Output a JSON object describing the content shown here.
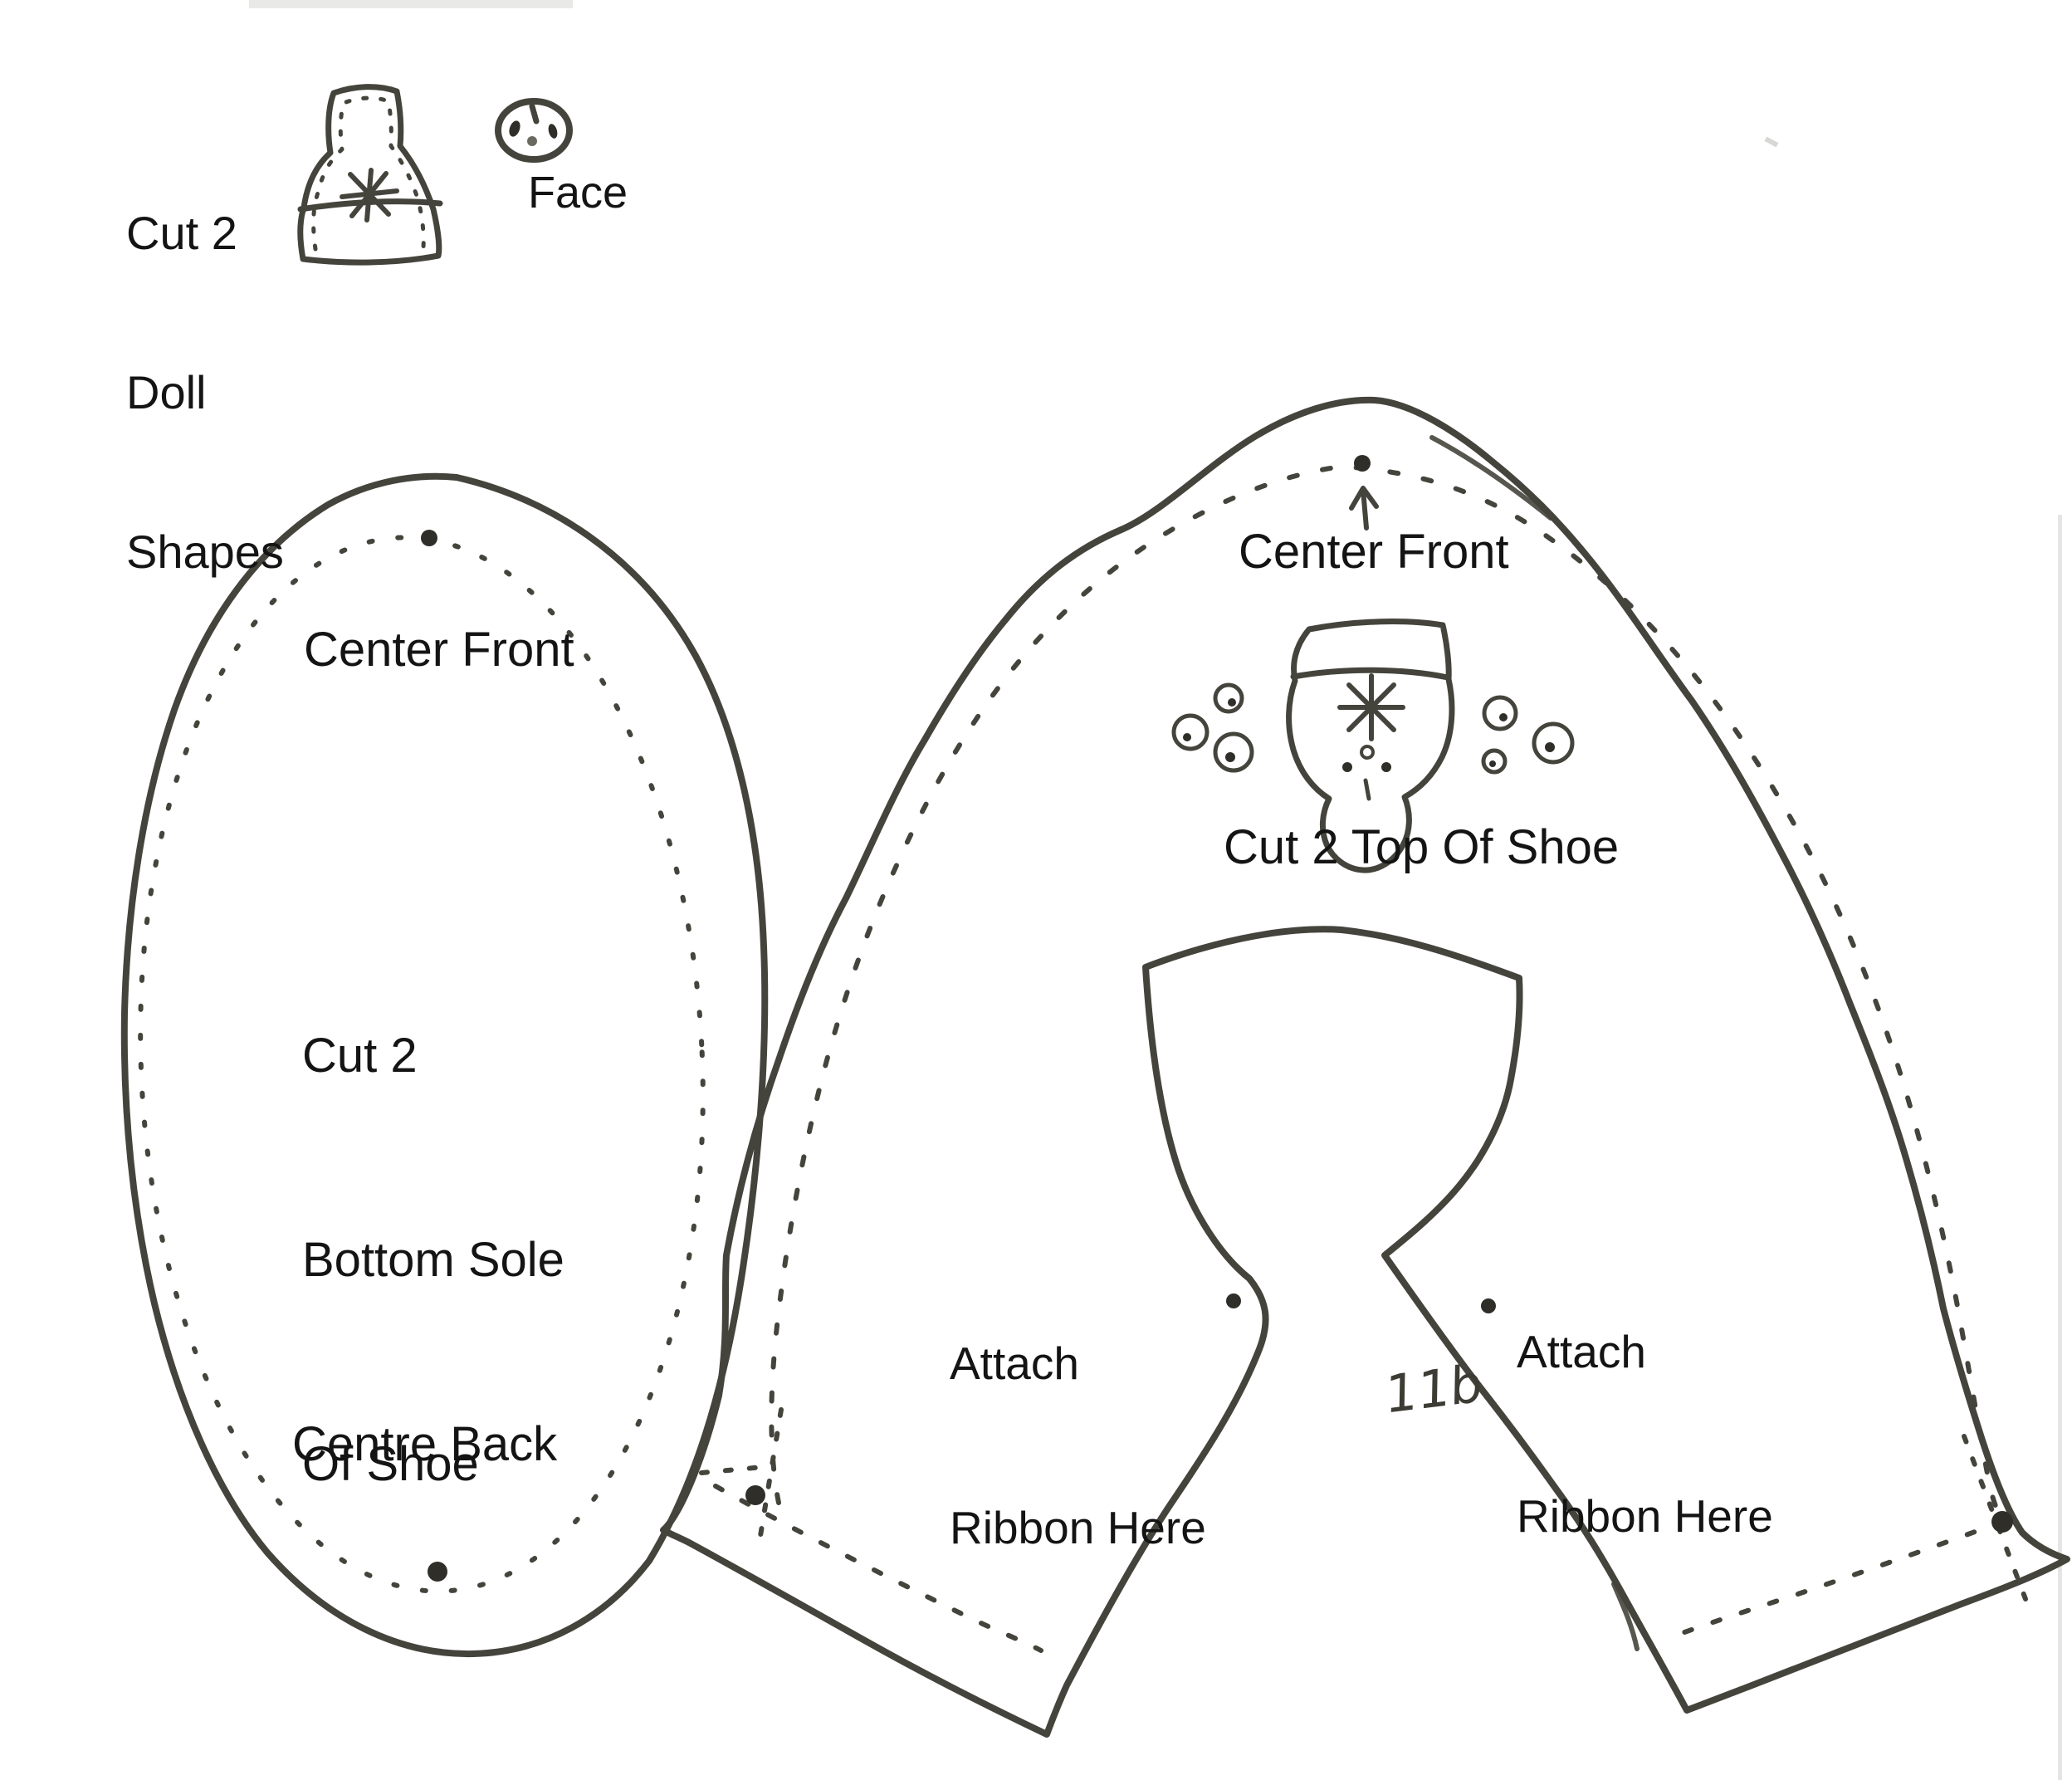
{
  "colors": {
    "ink": "#45443c",
    "dot": "#2f2e28",
    "text": "#141414",
    "paper": "#ffffff"
  },
  "annotations": {
    "doll_shapes": {
      "line1": "Cut 2",
      "line2": "Doll",
      "line3": "Shapes"
    },
    "face_label": "Face",
    "sole": {
      "center_front": "Center Front",
      "cut_line1": "Cut 2",
      "cut_line2": "Bottom Sole",
      "cut_line3": "Of Shoe",
      "centre_back": "Centre Back"
    },
    "shoe_top": {
      "center_front": "Center Front",
      "cut_label": "Cut 2 Top Of Shoe",
      "attach_left_line1": "Attach",
      "attach_left_line2": "Ribbon Here",
      "attach_right_line1": "Attach",
      "attach_right_line2": "Ribbon Here",
      "page_number": "11b"
    }
  }
}
